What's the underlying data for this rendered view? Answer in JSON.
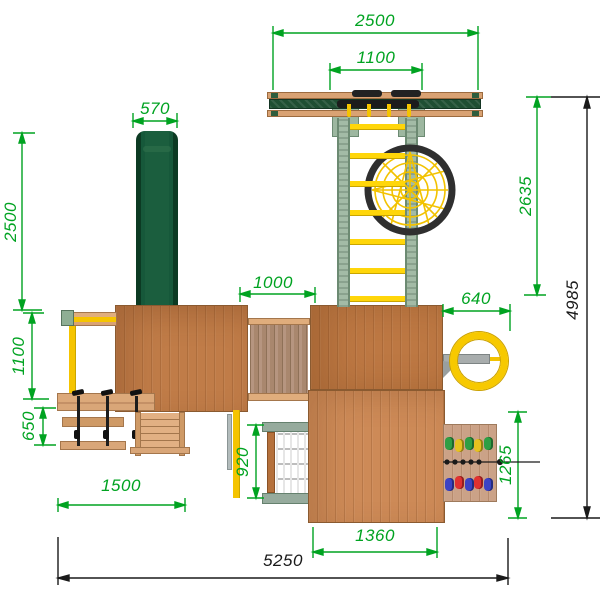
{
  "title": "playground-set-top-view-drawing",
  "dims": {
    "top_width": "2500",
    "top_inner_width": "1100",
    "slide_width": "570",
    "right_upper_height": "2635",
    "left_height": "2500",
    "bridge_width": "1000",
    "wheel_offset": "640",
    "total_height": "4985",
    "left_mid_height": "1100",
    "left_lower_height": "650",
    "left_width": "1500",
    "net_height": "920",
    "lower_tower_width": "1360",
    "wall_height": "1265",
    "total_width": "5250"
  },
  "colors": {
    "dimension_green": "#00A321",
    "dimension_black": "#1A1A1A",
    "roof_wood": "#C5814C",
    "slide_green": "#14512F",
    "accent_yellow": "#F5C400",
    "post_sage_green": "#A3BBA6",
    "beam_dark_green": "#1F4F33",
    "web_ring_black": "#2F2F2F",
    "hold_red": "#E03131",
    "hold_blue": "#3B43C4",
    "hold_green": "#2F9E44",
    "hold_yellow": "#E6C220"
  }
}
